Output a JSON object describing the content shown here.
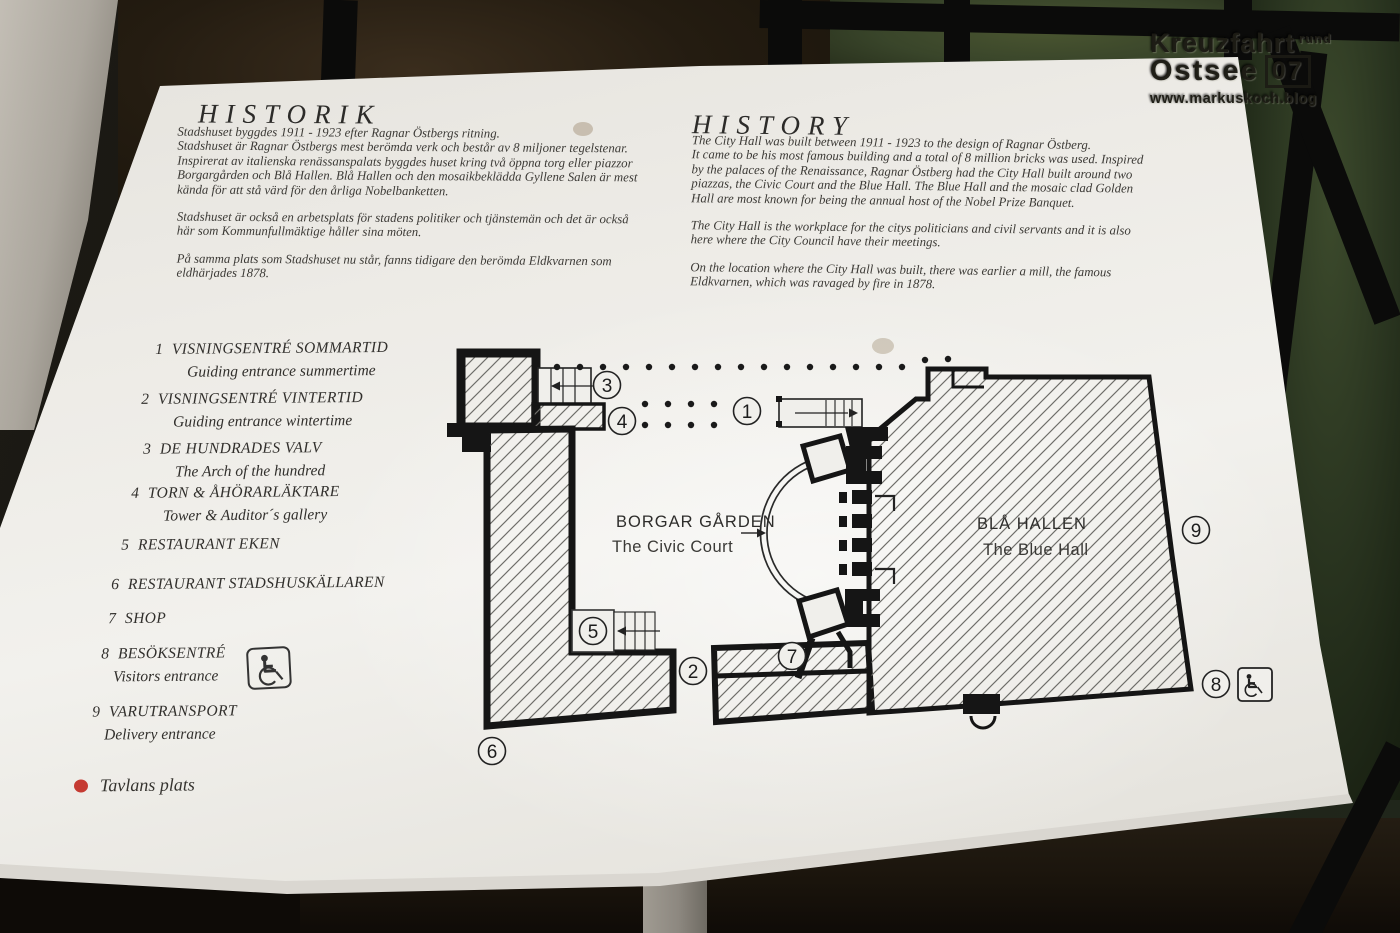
{
  "watermark": {
    "line1": "Kreuzfahrt",
    "line1_small": "rund",
    "line2": "Ostsee",
    "line2_badge": "07",
    "line3": "www.markuskoch.blog"
  },
  "sign": {
    "swedish": {
      "title": "HISTORIK",
      "paragraphs": [
        "Stadshuset byggdes 1911 - 1923 efter Ragnar Östbergs ritning.",
        "Stadshuset är Ragnar Östbergs mest berömda verk och består av 8 miljoner tegelstenar. Inspirerat av italienska renässanspalats byggdes huset kring två öppna torg eller piazzor Borgargården och Blå Hallen. Blå Hallen och den mosaikbeklädda Gyllene Salen är mest kända för att stå värd för den årliga Nobelbanketten.",
        "Stadshuset är också en arbetsplats för stadens politiker och tjänstemän och det är också här som Kommunfullmäktige håller sina möten.",
        "På samma plats som Stadshuset nu står, fanns tidigare den berömda Eldkvarnen som eldhärjades 1878."
      ]
    },
    "english": {
      "title": "HISTORY",
      "paragraphs": [
        "The City Hall was built between 1911 - 1923 to the design of Ragnar Östberg.",
        "It came to be his most famous building and a total of 8 million bricks was used. Inspired by the palaces of the Renaissance, Ragnar Östberg had the City Hall built around two piazzas, the Civic Court and the Blue Hall. The Blue Hall and the mosaic clad Golden Hall are most known for being the annual host of the Nobel Prize Banquet.",
        "The City Hall is the workplace for the citys politicians and civil servants and it is also here where the City Council have their meetings.",
        "On the location where the City Hall was built, there was earlier a mill, the famous Eldkvarnen, which was ravaged by fire in 1878."
      ]
    },
    "legend": {
      "items": [
        {
          "num": "1",
          "sv": "VISNINGSENTRÉ SOMMARTID",
          "en": "Guiding entrance summertime"
        },
        {
          "num": "2",
          "sv": "VISNINGSENTRÉ VINTERTID",
          "en": "Guiding entrance wintertime"
        },
        {
          "num": "3",
          "sv": "DE HUNDRADES VALV",
          "en": "The Arch of the hundred"
        },
        {
          "num": "4",
          "sv": "TORN & ÅHÖRARLÄKTARE",
          "en": "Tower & Auditor´s gallery"
        },
        {
          "num": "5",
          "sv": "RESTAURANT EKEN",
          "en": ""
        },
        {
          "num": "6",
          "sv": "RESTAURANT STADSHUSKÄLLAREN",
          "en": ""
        },
        {
          "num": "7",
          "sv": "SHOP",
          "en": ""
        },
        {
          "num": "8",
          "sv": "BESÖKSENTRÉ",
          "en": "Visitors entrance",
          "icon": "wheelchair"
        },
        {
          "num": "9",
          "sv": "VARUTRANSPORT",
          "en": "Delivery entrance"
        }
      ],
      "marker_label": "Tavlans plats",
      "marker_color": "#c53a32"
    },
    "map": {
      "labels": {
        "court_sv": "BORGAR GÅRDEN",
        "court_en": "The Civic Court",
        "hall_sv": "BLÅ HALLEN",
        "hall_en": "The Blue Hall"
      },
      "numbers": [
        "1",
        "2",
        "3",
        "4",
        "5",
        "6",
        "7",
        "8",
        "9"
      ]
    }
  }
}
